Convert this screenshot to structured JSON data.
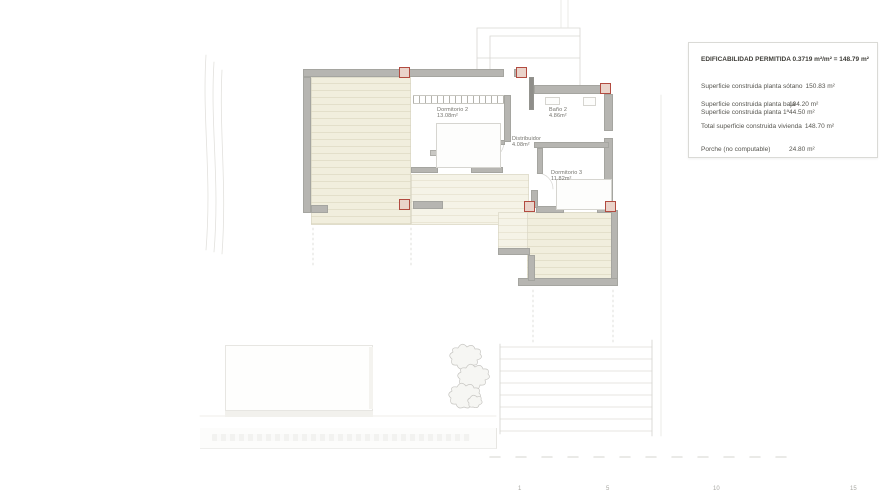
{
  "legend": {
    "title": "EDIFICABILIDAD PERMITIDA 0.3719 m²/m² = 148.79 m²",
    "rows": [
      {
        "label": "Superficie construida planta sótano",
        "value": "150.83 m²"
      },
      {
        "label": "Superficie construida planta baja",
        "value": "104.20 m²"
      },
      {
        "label": "Superficie construida planta 1ª",
        "value": "44.50 m²"
      },
      {
        "label": "Total superficie construida vivienda",
        "value": "148.70 m²"
      },
      {
        "label": "Porche (no computable)",
        "value": "24.80 m²"
      }
    ]
  },
  "rooms": [
    {
      "name": "Dormitorio 2",
      "area": "13.08m²"
    },
    {
      "name": "Distribuidor",
      "area": "4.08m²"
    },
    {
      "name": "Baño 2",
      "area": "4.86m²"
    },
    {
      "name": "Dormitorio 3",
      "area": "11.82m²"
    }
  ],
  "scale_bar": {
    "ticks": [
      "1",
      "5",
      "10",
      "15"
    ]
  },
  "colors": {
    "wall": "#b6b5b1",
    "deck": "#f1eedd",
    "pillar_accent": "#b24b40",
    "faint_line": "#deddd9"
  }
}
